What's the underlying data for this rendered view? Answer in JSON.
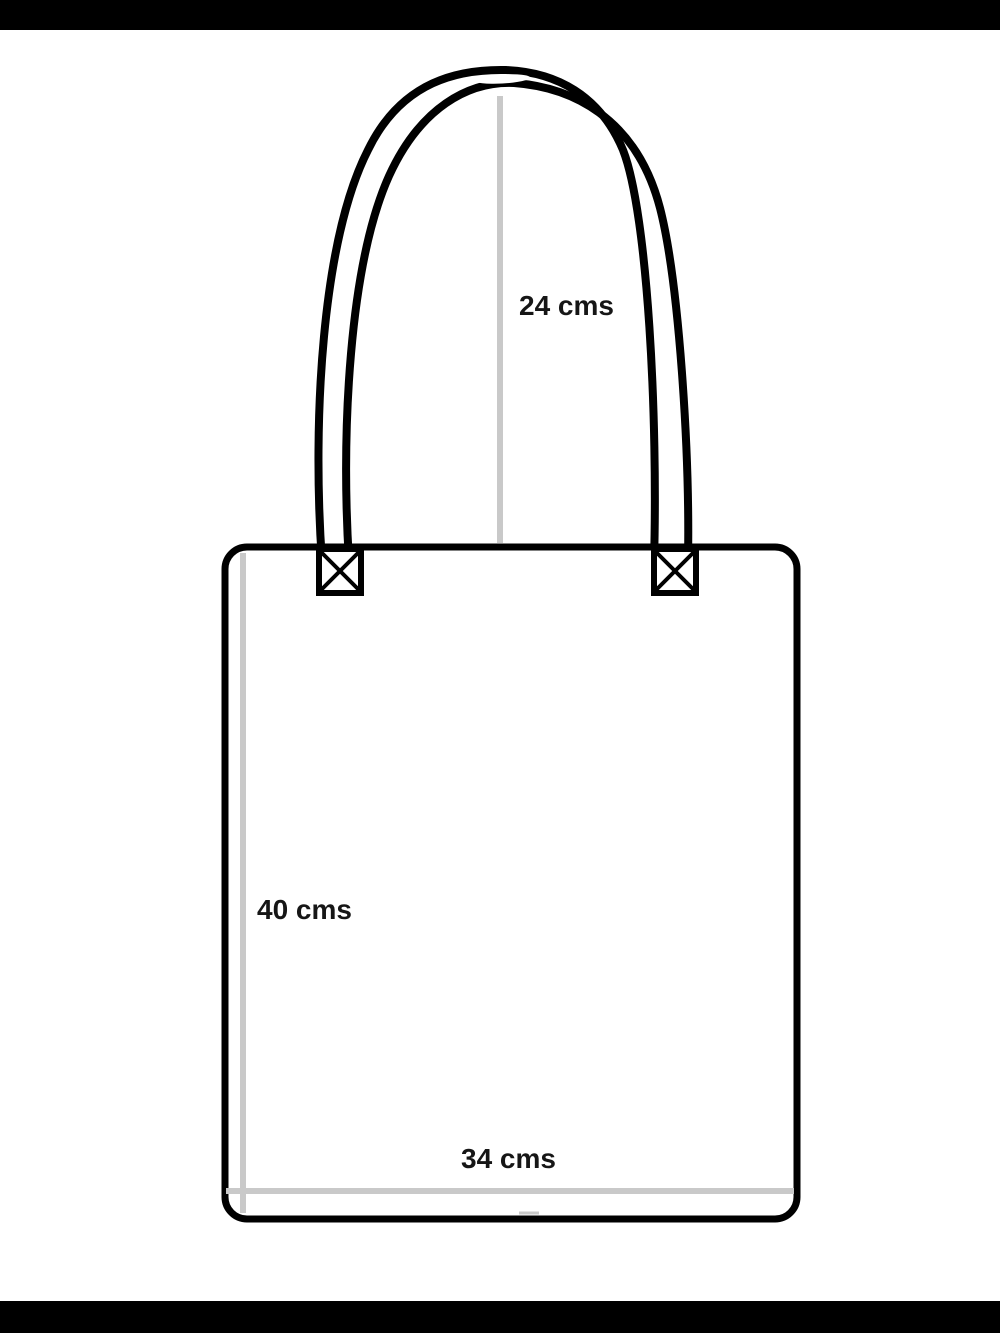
{
  "page": {
    "background_color": "#ffffff",
    "letterbox_color": "#000000"
  },
  "diagram": {
    "name": "Tote bag measurement diagram",
    "labels": {
      "handle_height": "24 cms",
      "bag_height": "40 cms",
      "bag_width": "34 cms"
    },
    "colors": {
      "outline": "#000000",
      "measure_line": "#c9c9c9",
      "text": "#161616",
      "fill": "#ffffff"
    }
  }
}
